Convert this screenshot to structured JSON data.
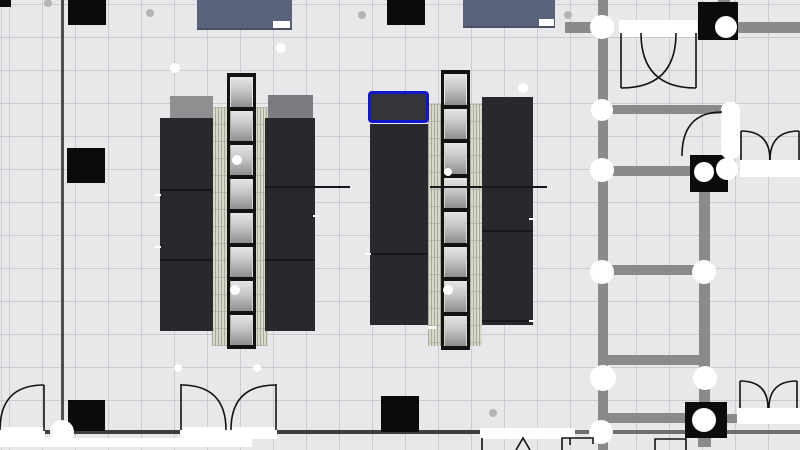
{
  "app": {
    "view": "floor-plan-canvas",
    "selection_count": 1
  },
  "palette": {
    "bg": "#e8e8ea",
    "grid": "#cbcbcf",
    "wall": "#8a8a8a",
    "wallDark": "#474747",
    "black": "#0b0b0b",
    "white": "#ffffff",
    "desk": "#28292d",
    "deskLine": "#17181b",
    "spineLight": "#d9d9c9",
    "spineDark": "#a9a99b",
    "frame": "#121212",
    "cabinetA": "#8f8f91",
    "cabinetB": "#7b7c81",
    "panelBlue": "#59627b",
    "selection": "#1316c9",
    "dotGray": "#b4b4b6",
    "arc": "#141414"
  },
  "walls": [
    {
      "x": 598,
      "y": 0,
      "w": 10,
      "h": 450
    },
    {
      "x": 699,
      "y": 190,
      "w": 11,
      "h": 214
    },
    {
      "x": 698,
      "y": 437,
      "w": 13,
      "h": 10
    },
    {
      "x": 718,
      "y": 0,
      "w": 12,
      "h": 4
    },
    {
      "x": 565,
      "y": 22,
      "w": 33,
      "h": 11
    },
    {
      "x": 737,
      "y": 22,
      "w": 63,
      "h": 11
    },
    {
      "x": 608,
      "y": 105,
      "w": 114,
      "h": 9
    },
    {
      "x": 608,
      "y": 166,
      "w": 82,
      "h": 10
    },
    {
      "x": 608,
      "y": 265,
      "w": 91,
      "h": 10
    },
    {
      "x": 608,
      "y": 355,
      "w": 91,
      "h": 10
    },
    {
      "x": 608,
      "y": 413,
      "w": 77,
      "h": 10
    },
    {
      "x": 727,
      "y": 414,
      "w": 10,
      "h": 9
    }
  ],
  "thin_lines": [
    {
      "x": 61,
      "y": 0,
      "w": 3,
      "h": 432,
      "c": "#4f4f4f"
    },
    {
      "x": 0,
      "y": 430,
      "w": 480,
      "h": 4,
      "c": "#3f3f3f"
    },
    {
      "x": 480,
      "y": 430,
      "w": 320,
      "h": 4,
      "c": "#6f6f6f"
    }
  ],
  "columns": [
    {
      "x": 0,
      "y": 0,
      "w": 11,
      "h": 7
    },
    {
      "x": 68,
      "y": 0,
      "w": 38,
      "h": 25
    },
    {
      "x": 387,
      "y": 0,
      "w": 38,
      "h": 25
    },
    {
      "x": 67,
      "y": 148,
      "w": 38,
      "h": 35
    },
    {
      "x": 68,
      "y": 400,
      "w": 37,
      "h": 31
    },
    {
      "x": 381,
      "y": 396,
      "w": 38,
      "h": 36
    },
    {
      "x": 698,
      "y": 2,
      "w": 40,
      "h": 38
    },
    {
      "x": 690,
      "y": 155,
      "w": 38,
      "h": 37
    },
    {
      "x": 685,
      "y": 402,
      "w": 42,
      "h": 36
    }
  ],
  "white_bands": [
    {
      "x": 0,
      "y": 427,
      "w": 45,
      "h": 12
    },
    {
      "x": 180,
      "y": 427,
      "w": 97,
      "h": 12
    },
    {
      "x": 480,
      "y": 428,
      "w": 95,
      "h": 11
    },
    {
      "x": 0,
      "y": 438,
      "w": 252,
      "h": 9
    },
    {
      "x": 619,
      "y": 20,
      "w": 78,
      "h": 17
    },
    {
      "x": 740,
      "y": 160,
      "w": 60,
      "h": 17
    },
    {
      "x": 737,
      "y": 408,
      "w": 63,
      "h": 16
    }
  ],
  "door_leaves": [
    {
      "x": 721,
      "y": 102,
      "w": 19,
      "h": 57
    }
  ],
  "junction_circles": [
    {
      "x": 602,
      "y": 27,
      "r": 12
    },
    {
      "x": 602,
      "y": 110,
      "r": 11
    },
    {
      "x": 602,
      "y": 170,
      "r": 12
    },
    {
      "x": 602,
      "y": 272,
      "r": 12
    },
    {
      "x": 704,
      "y": 272,
      "r": 12
    },
    {
      "x": 603,
      "y": 378,
      "r": 13
    },
    {
      "x": 705,
      "y": 378,
      "r": 12
    },
    {
      "x": 601,
      "y": 432,
      "r": 12
    },
    {
      "x": 62,
      "y": 432,
      "r": 12
    },
    {
      "x": 726,
      "y": 27,
      "r": 11
    },
    {
      "x": 704,
      "y": 172,
      "r": 10
    },
    {
      "x": 727,
      "y": 169,
      "r": 11
    },
    {
      "x": 704,
      "y": 420,
      "r": 12
    }
  ],
  "decor_dots": [
    {
      "x": 175,
      "y": 68,
      "r": 5,
      "kind": "white"
    },
    {
      "x": 281,
      "y": 48,
      "r": 5,
      "kind": "white"
    },
    {
      "x": 523,
      "y": 88,
      "r": 5,
      "kind": "white"
    },
    {
      "x": 237,
      "y": 160,
      "r": 5,
      "kind": "white"
    },
    {
      "x": 235,
      "y": 290,
      "r": 5,
      "kind": "white"
    },
    {
      "x": 448,
      "y": 290,
      "r": 5,
      "kind": "white"
    },
    {
      "x": 448,
      "y": 172,
      "r": 4,
      "kind": "white"
    },
    {
      "x": 178,
      "y": 368,
      "r": 4,
      "kind": "white"
    },
    {
      "x": 257,
      "y": 368,
      "r": 4,
      "kind": "white"
    },
    {
      "x": 48,
      "y": 3,
      "r": 4,
      "kind": "gray"
    },
    {
      "x": 150,
      "y": 13,
      "r": 4,
      "kind": "gray"
    },
    {
      "x": 362,
      "y": 15,
      "r": 4,
      "kind": "gray"
    },
    {
      "x": 568,
      "y": 15,
      "r": 4,
      "kind": "gray"
    },
    {
      "x": 493,
      "y": 413,
      "r": 4,
      "kind": "gray"
    }
  ],
  "top_panels": [
    {
      "x": 197,
      "y": 0,
      "w": 95,
      "h": 28,
      "notch": {
        "x": 273,
        "y": 21,
        "w": 17,
        "h": 7
      }
    },
    {
      "x": 463,
      "y": 0,
      "w": 92,
      "h": 26,
      "notch": {
        "x": 539,
        "y": 19,
        "w": 15,
        "h": 7
      }
    }
  ],
  "clusters": [
    {
      "spine": {
        "x": 212,
        "y": 107,
        "w": 56,
        "h": 239
      },
      "cabinets": [
        {
          "x": 170,
          "y": 96,
          "w": 43,
          "h": 25,
          "tone": "cabinetA"
        },
        {
          "x": 268,
          "y": 95,
          "w": 45,
          "h": 25,
          "tone": "cabinetB"
        }
      ],
      "desks": [
        {
          "x": 160,
          "y": 118,
          "w": 53,
          "h": 213
        },
        {
          "x": 265,
          "y": 118,
          "w": 50,
          "h": 213
        }
      ],
      "ladder": {
        "x": 227,
        "w": 29,
        "top": 73,
        "bottom": 349,
        "cells": 8
      }
    },
    {
      "spine": {
        "x": 428,
        "y": 104,
        "w": 54,
        "h": 242
      },
      "cabinets": [],
      "desks": [
        {
          "x": 370,
          "y": 124,
          "w": 58,
          "h": 201
        },
        {
          "x": 482,
          "y": 97,
          "w": 51,
          "h": 228
        }
      ],
      "ladder": {
        "x": 441,
        "w": 29,
        "top": 70,
        "bottom": 350,
        "cells": 8
      }
    }
  ],
  "selection_desk": {
    "x": 368,
    "y": 91,
    "w": 61,
    "h": 32
  },
  "furniture_lines": [
    {
      "x": 160,
      "y": 189,
      "w": 53,
      "h": 2
    },
    {
      "x": 160,
      "y": 259,
      "w": 53,
      "h": 2
    },
    {
      "x": 265,
      "y": 186,
      "w": 85,
      "h": 2
    },
    {
      "x": 265,
      "y": 259,
      "w": 50,
      "h": 2
    },
    {
      "x": 430,
      "y": 186,
      "w": 117,
      "h": 2
    },
    {
      "x": 370,
      "y": 253,
      "w": 58,
      "h": 2
    },
    {
      "x": 482,
      "y": 230,
      "w": 51,
      "h": 2
    },
    {
      "x": 482,
      "y": 320,
      "w": 51,
      "h": 2
    }
  ],
  "white_ticks": [
    {
      "x": 155,
      "y": 194,
      "w": 6,
      "h": 2
    },
    {
      "x": 155,
      "y": 246,
      "w": 6,
      "h": 2
    },
    {
      "x": 313,
      "y": 215,
      "w": 6,
      "h": 2
    },
    {
      "x": 365,
      "y": 253,
      "w": 6,
      "h": 2
    },
    {
      "x": 529,
      "y": 218,
      "w": 6,
      "h": 2
    },
    {
      "x": 529,
      "y": 320,
      "w": 6,
      "h": 2
    },
    {
      "x": 428,
      "y": 326,
      "w": 8,
      "h": 3
    }
  ],
  "door_arcs": [
    {
      "d": "M 44 385 L 44 431"
    },
    {
      "d": "M 44 385 Q 0 385 0 430"
    },
    {
      "d": "M 181 384 L 181 430"
    },
    {
      "d": "M 181 385 Q 226 385 226 430"
    },
    {
      "d": "M 276 384 L 276 430"
    },
    {
      "d": "M 276 385 Q 231 385 231 430"
    },
    {
      "d": "M 621 33 L 621 88"
    },
    {
      "d": "M 696 33 L 696 88"
    },
    {
      "d": "M 621 88 Q 676 88 676 33"
    },
    {
      "d": "M 696 88 Q 641 88 641 33"
    },
    {
      "d": "M 722 112 Q 682 112 682 156"
    },
    {
      "d": "M 741 160 L 741 131"
    },
    {
      "d": "M 799 160 L 799 131"
    },
    {
      "d": "M 741 131 Q 770 131 770 160"
    },
    {
      "d": "M 799 131 Q 770 131 770 160"
    },
    {
      "d": "M 740 408 L 740 381"
    },
    {
      "d": "M 797 408 L 797 381"
    },
    {
      "d": "M 740 381 Q 768 381 768 408"
    },
    {
      "d": "M 797 381 Q 769 381 769 408"
    }
  ],
  "partial_fixtures": [
    {
      "d": "M 482 438 L 482 450"
    },
    {
      "d": "M 516 450 L 523 438 L 530 450"
    },
    {
      "d": "M 562 450 L 562 438 L 593 438 L 593 444"
    },
    {
      "d": "M 570 438 L 570 445"
    },
    {
      "d": "M 655 450 L 655 439 L 686 439 L 686 450"
    }
  ]
}
